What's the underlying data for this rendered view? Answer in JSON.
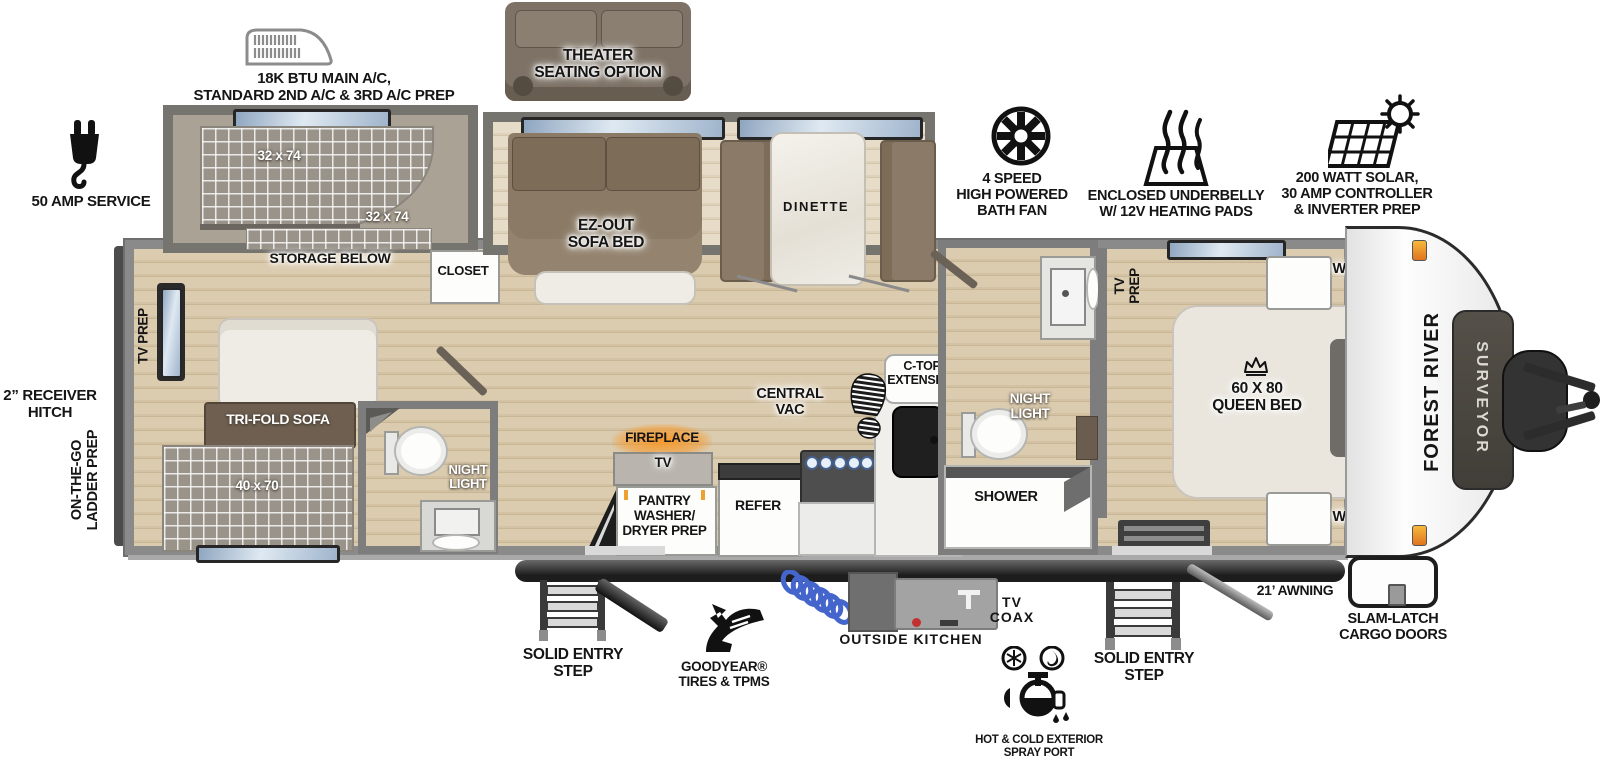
{
  "colors": {
    "wall_gray": "#8a8a8a",
    "floor_wood": "#d3c2a3",
    "sofa_brown": "#85755f",
    "dark_brown": "#6e5f50",
    "fireplace_glow": "#f59a2d",
    "hose_blue": "#4466cc",
    "window_blue": "#9fb4cc",
    "frame_dark": "#2a2a2a"
  },
  "features": {
    "ac": "18K BTU MAIN A/C,\nSTANDARD 2ND A/C & 3RD A/C PREP",
    "theater": "THEATER\nSEATING OPTION",
    "fan": "4 SPEED\nHIGH POWERED\nBATH FAN",
    "underbelly": "ENCLOSED UNDERBELLY\nW/ 12V HEATING PADS",
    "solar": "200 WATT SOLAR,\n30 AMP CONTROLLER\n& INVERTER PREP",
    "amp_service": "50 AMP SERVICE",
    "receiver_hitch": "2” RECEIVER\nHITCH",
    "ladder_prep": "ON-THE-GO\nLADDER PREP",
    "step_left": "SOLID ENTRY\nSTEP",
    "goodyear": "GOODYEAR®\nTIRES & TPMS",
    "outside_kitchen": "OUTSIDE KITCHEN",
    "tv_coax": "TV\nCOAX",
    "spray_port": "HOT & COLD EXTERIOR\nSPRAY PORT",
    "step_right": "SOLID ENTRY\nSTEP",
    "awning": "21’ AWNING",
    "cargo_doors": "SLAM-LATCH\nCARGO DOORS"
  },
  "interior": {
    "tv_prep_rear": "TV PREP",
    "bunk_upper": "32 x 74",
    "bunk_lower": "32 x 74",
    "storage_below": "STORAGE BELOW",
    "closet": "CLOSET",
    "tri_fold_sofa": "TRI-FOLD SOFA",
    "rear_bed": "40 x 70",
    "night_light_rear": "NIGHT\nLIGHT",
    "ez_sofa": "EZ-OUT\nSOFA BED",
    "dinette": "DINETTE",
    "central_vac": "CENTRAL\nVAC",
    "ctop_extension": "C-TOP\nEXTENSION",
    "fireplace": "FIREPLACE",
    "tv": "TV",
    "pantry": "PANTRY\nWASHER/\nDRYER PREP",
    "refer": "REFER",
    "night_light_main": "NIGHT\nLIGHT",
    "shower": "SHOWER",
    "tv_prep_bedroom": "TV\nPREP",
    "ward_top": "WARD",
    "queen_bed": "60 X 80\nQUEEN BED",
    "oh_storage": "O/H STORAGE",
    "ward_bottom": "WARD"
  },
  "branding": {
    "make": "FOREST RIVER",
    "model": "SURVEYOR"
  }
}
